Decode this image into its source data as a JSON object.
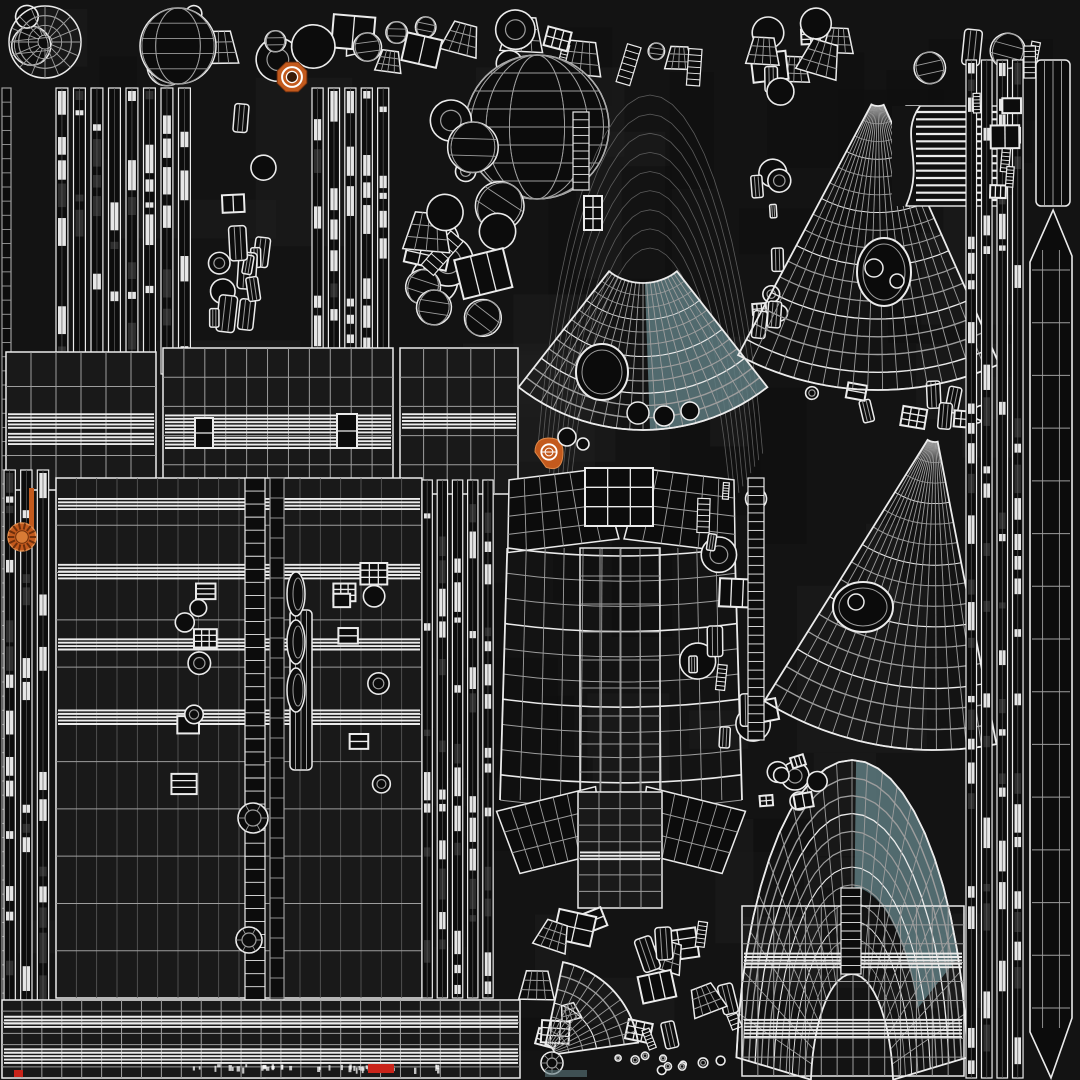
{
  "subject": "3D model UV wireframe texture atlas",
  "canvas": {
    "width": 1080,
    "height": 1080
  },
  "colors": {
    "background": "#131313",
    "line": "#ebebeb",
    "lineDim": "#9d9d9d",
    "lineFaint": "#5c5c5c",
    "fillDark": "#0c0c0c",
    "fillPanel": "#191919",
    "teal": "#5d7a7f",
    "tealLine": "#d9e4e4",
    "orange": "#c35a1d",
    "orangeLight": "#e08a4a",
    "red": "#c9241a",
    "white": "#ffffff"
  },
  "islands": [
    {
      "name": "background-patches",
      "type": "patchfield",
      "x": 0,
      "y": 0,
      "w": 1080,
      "h": 1080,
      "seed": 2,
      "count": 70
    },
    {
      "name": "top-parts-row",
      "type": "scatter",
      "x": 6,
      "y": 4,
      "w": 1054,
      "h": 82,
      "seed": 7,
      "count": 44,
      "kinds": [
        "winrect",
        "ring",
        "cyl",
        "sphere",
        "cone",
        "ladder"
      ],
      "smin": 16,
      "smax": 44,
      "rotmax": 18
    },
    {
      "name": "turbine-part",
      "type": "radialfan",
      "cx": 45,
      "cy": 42,
      "r0": 7,
      "r1": 36,
      "a0": 0,
      "a1": 360,
      "nr": 3,
      "ns": 16,
      "outline": true
    },
    {
      "name": "sphere-part-small",
      "type": "sphere",
      "cx": 178,
      "cy": 46,
      "r": 38,
      "nlat": 5,
      "nlon": 5
    },
    {
      "name": "orange-badge-top",
      "type": "badge",
      "style": "octagon",
      "cx": 292,
      "cy": 77,
      "r": 16
    },
    {
      "name": "sphere-part-large",
      "type": "sphere",
      "cx": 537,
      "cy": 127,
      "r": 72,
      "nlat": 8,
      "nlon": 8
    },
    {
      "name": "left-edge-ladder",
      "type": "ladder",
      "x": 2,
      "y": 88,
      "w": 9,
      "h": 990,
      "n": 70,
      "dim": true
    },
    {
      "name": "left-strip-bundle",
      "type": "vstrips",
      "x": 56,
      "y": 88,
      "w": 140,
      "h": 286,
      "count": 8,
      "seed": 3
    },
    {
      "name": "left-part-column",
      "type": "scatter",
      "x": 198,
      "y": 92,
      "w": 110,
      "h": 276,
      "seed": 11,
      "count": 14,
      "kinds": [
        "winrect",
        "cyl",
        "ring"
      ],
      "smin": 18,
      "smax": 40,
      "rotmax": 10
    },
    {
      "name": "mid-strip-bundle",
      "type": "vstrips",
      "x": 312,
      "y": 88,
      "w": 82,
      "h": 284,
      "count": 5,
      "seed": 5
    },
    {
      "name": "upper-mid-cluster",
      "type": "scatter",
      "x": 398,
      "y": 90,
      "w": 138,
      "h": 250,
      "seed": 9,
      "count": 16,
      "kinds": [
        "winrect",
        "ring",
        "cyl",
        "sphere",
        "cone",
        "ladder"
      ],
      "smin": 18,
      "smax": 52,
      "rotmax": 45
    },
    {
      "name": "upper-arc-band",
      "type": "radialfan",
      "cx": 650,
      "cy": 640,
      "r0": 392,
      "r1": 545,
      "a0": 200,
      "a1": 340,
      "nr": 8,
      "ns": 0,
      "aspect": 0.22,
      "dim": true
    },
    {
      "name": "arc-band-ladder",
      "type": "ladder",
      "x": 573,
      "y": 112,
      "w": 16,
      "h": 78,
      "n": 10
    },
    {
      "name": "arc-band-hatch",
      "type": "winrect",
      "x": 584,
      "y": 196,
      "w": 18,
      "h": 34,
      "cols": 2,
      "rows": 3
    },
    {
      "name": "eye-mesh",
      "type": "radialfan",
      "cx": 643,
      "cy": 228,
      "r0": 55,
      "r1": 202,
      "a0": 52,
      "a1": 128,
      "nr": 12,
      "ns": 20,
      "outline": true,
      "teal": {
        "a0": 52,
        "a1": 88,
        "r0": 55,
        "r1": 202
      },
      "hole": {
        "cx": 602,
        "cy": 372,
        "rx": 26,
        "ry": 28
      },
      "subholes": [
        [
          638,
          413,
          11
        ],
        [
          664,
          416,
          10
        ],
        [
          690,
          411,
          9
        ]
      ]
    },
    {
      "name": "hull-panel-a",
      "type": "hgrid",
      "x": 6,
      "y": 352,
      "w": 150,
      "h": 138,
      "nx": 6,
      "ny": 4,
      "bands": [
        {
          "fy": 0.5,
          "n": 5
        },
        {
          "fy": 0.63,
          "n": 4
        }
      ]
    },
    {
      "name": "hull-panel-b",
      "type": "hgrid",
      "x": 163,
      "y": 348,
      "w": 230,
      "h": 146,
      "nx": 11,
      "ny": 5,
      "bands": [
        {
          "fy": 0.52,
          "n": 6
        },
        {
          "fy": 0.65,
          "n": 4
        }
      ]
    },
    {
      "name": "hull-panel-c",
      "type": "hgrid",
      "x": 400,
      "y": 348,
      "w": 118,
      "h": 146,
      "nx": 5,
      "ny": 5,
      "bands": [
        {
          "fy": 0.5,
          "n": 5
        }
      ]
    },
    {
      "name": "hatch-detail-a",
      "type": "winrect",
      "x": 195,
      "y": 418,
      "w": 18,
      "h": 30,
      "cols": 1,
      "rows": 2
    },
    {
      "name": "hatch-detail-b",
      "type": "winrect",
      "x": 337,
      "y": 414,
      "w": 20,
      "h": 34,
      "cols": 1,
      "rows": 2
    },
    {
      "name": "left-column-strips",
      "type": "vstrips",
      "x": 4,
      "y": 470,
      "w": 50,
      "h": 606,
      "count": 3,
      "seed": 13
    },
    {
      "name": "orange-strip",
      "type": "orect",
      "x": 29,
      "y": 488,
      "w": 5,
      "h": 50
    },
    {
      "name": "orange-badge-left",
      "type": "badge",
      "style": "ribbed",
      "cx": 22,
      "cy": 537,
      "r": 14
    },
    {
      "name": "mid-hull-grid",
      "type": "hgrid",
      "x": 56,
      "y": 478,
      "w": 366,
      "h": 520,
      "nx": 18,
      "ny": 11,
      "dimv": true,
      "bands": [
        {
          "fy": 0.05,
          "n": 4
        },
        {
          "fy": 0.18,
          "n": 5
        },
        {
          "fy": 0.32,
          "n": 4
        },
        {
          "fy": 0.46,
          "n": 5
        }
      ]
    },
    {
      "name": "hatch-row-left",
      "type": "scatter",
      "x": 168,
      "y": 562,
      "w": 58,
      "h": 244,
      "seed": 17,
      "count": 8,
      "kinds": [
        "winrect",
        "ring"
      ],
      "smin": 14,
      "smax": 28,
      "rotmax": 0
    },
    {
      "name": "hatch-row-right",
      "type": "scatter",
      "x": 330,
      "y": 560,
      "w": 62,
      "h": 246,
      "seed": 19,
      "count": 8,
      "kinds": [
        "winrect",
        "ring"
      ],
      "smin": 14,
      "smax": 28,
      "rotmax": 0
    },
    {
      "name": "spine-ladder-a",
      "type": "ladder",
      "x": 245,
      "y": 478,
      "w": 20,
      "h": 600,
      "n": 46
    },
    {
      "name": "spine-ladder-b",
      "type": "ladder",
      "x": 270,
      "y": 478,
      "w": 14,
      "h": 600,
      "n": 30,
      "dim": true
    },
    {
      "name": "spine-cyl",
      "type": "cyl",
      "x": 290,
      "y": 610,
      "w": 22,
      "h": 160,
      "n": 4
    },
    {
      "name": "spine-crescents",
      "type": "crescents",
      "cx": 296,
      "ys": [
        594,
        642,
        690
      ],
      "rx": 9,
      "ry": 22
    },
    {
      "name": "grommet-a",
      "type": "ring",
      "cx": 253,
      "cy": 818,
      "r": 15,
      "r2": 8,
      "spokes": 6
    },
    {
      "name": "grommet-b",
      "type": "ring",
      "cx": 249,
      "cy": 940,
      "r": 13,
      "r2": 7,
      "spokes": 6
    },
    {
      "name": "grommet-c",
      "type": "ring",
      "cx": 247,
      "cy": 1042,
      "r": 11,
      "r2": 6,
      "spokes": 6
    },
    {
      "name": "right-of-hull-strips",
      "type": "vstrips",
      "x": 422,
      "y": 480,
      "w": 76,
      "h": 518,
      "count": 5,
      "seed": 39
    },
    {
      "name": "bottom-left-dense-grid",
      "type": "hgrid",
      "x": 2,
      "y": 1000,
      "w": 518,
      "h": 78,
      "nx": 26,
      "ny": 7,
      "bands": [
        {
          "fy": 0.28,
          "n": 4
        },
        {
          "fy": 0.72,
          "n": 5
        }
      ]
    },
    {
      "name": "vessel-shoulder-left",
      "type": "cone",
      "x": 503,
      "y": 474,
      "w": 112,
      "h": 72,
      "tw": 0.82,
      "bw": 1,
      "rot": -7,
      "nx": 6,
      "ny": 4
    },
    {
      "name": "vessel-shoulder-right",
      "type": "cone",
      "x": 628,
      "y": 474,
      "w": 112,
      "h": 72,
      "tw": 0.82,
      "bw": 1,
      "rot": 7,
      "nx": 6,
      "ny": 4
    },
    {
      "name": "vessel-collar",
      "type": "winrect",
      "x": 585,
      "y": 468,
      "w": 68,
      "h": 58,
      "cols": 3,
      "rows": 3
    },
    {
      "name": "vessel-body",
      "type": "bulgegrid",
      "x": 500,
      "y": 548,
      "w": 242,
      "h": 252,
      "nx": 12,
      "ny": 10,
      "bulge": 16,
      "taper": 0.94
    },
    {
      "name": "vessel-center-band",
      "type": "hgrid",
      "x": 580,
      "y": 548,
      "w": 80,
      "h": 252,
      "nx": 4,
      "ny": 9,
      "nofill": true
    },
    {
      "name": "vessel-skirt-left",
      "type": "cone",
      "x": 503,
      "y": 798,
      "w": 102,
      "h": 66,
      "tw": 1,
      "bw": 0.85,
      "rot": -14,
      "nx": 7,
      "ny": 3
    },
    {
      "name": "vessel-skirt-right",
      "type": "cone",
      "x": 637,
      "y": 798,
      "w": 102,
      "h": 66,
      "tw": 1,
      "bw": 0.85,
      "rot": 14,
      "nx": 7,
      "ny": 3
    },
    {
      "name": "vessel-neck",
      "type": "hgrid",
      "x": 578,
      "y": 792,
      "w": 84,
      "h": 116,
      "nx": 4,
      "ny": 7,
      "bands": [
        {
          "fy": 0.55,
          "n": 3
        }
      ]
    },
    {
      "name": "orange-badge-center",
      "type": "badge",
      "style": "teardrop",
      "cx": 549,
      "cy": 452,
      "r": 14
    },
    {
      "name": "vessel-rivet-a",
      "type": "ring",
      "cx": 567,
      "cy": 437,
      "r": 9
    },
    {
      "name": "vessel-rivet-b",
      "type": "ring",
      "cx": 583,
      "cy": 444,
      "r": 6
    },
    {
      "name": "lower-center-cluster",
      "type": "scatter",
      "x": 518,
      "y": 902,
      "w": 238,
      "h": 148,
      "seed": 23,
      "count": 20,
      "kinds": [
        "cyl",
        "ladder",
        "ring",
        "winrect",
        "cone"
      ],
      "smin": 14,
      "smax": 42,
      "rotmax": 22
    },
    {
      "name": "lower-fan-wedge",
      "type": "radialfan",
      "cx": 543,
      "cy": 1056,
      "r0": 12,
      "r1": 96,
      "a0": -78,
      "a1": -8,
      "nr": 6,
      "ns": 10,
      "outline": true
    },
    {
      "name": "gauge-ring",
      "type": "ring",
      "cx": 552,
      "cy": 1063,
      "r": 11,
      "r2": 5,
      "spokes": 8
    },
    {
      "name": "bottom-rivet-row",
      "type": "scatter",
      "x": 612,
      "y": 1052,
      "w": 150,
      "h": 24,
      "seed": 27,
      "count": 10,
      "kinds": [
        "ring"
      ],
      "smin": 6,
      "smax": 10,
      "rotmax": 0
    },
    {
      "name": "right-of-vessel-cluster",
      "type": "scatter",
      "x": 678,
      "y": 436,
      "w": 100,
      "h": 316,
      "seed": 37,
      "count": 14,
      "kinds": [
        "winrect",
        "cyl",
        "ring",
        "ladder"
      ],
      "smin": 14,
      "smax": 36,
      "rotmax": 12
    },
    {
      "name": "right-of-vessel-ladder",
      "type": "ladder",
      "x": 748,
      "y": 478,
      "w": 16,
      "h": 262,
      "n": 30
    },
    {
      "name": "eye-fan-gap-cluster",
      "type": "scatter",
      "x": 742,
      "y": 62,
      "w": 52,
      "h": 300,
      "seed": 33,
      "count": 12,
      "kinds": [
        "winrect",
        "cyl",
        "ring"
      ],
      "smin": 12,
      "smax": 30,
      "rotmax": 8
    },
    {
      "name": "fan-gap-cluster",
      "type": "scatter",
      "x": 768,
      "y": 380,
      "w": 230,
      "h": 50,
      "seed": 31,
      "count": 10,
      "kinds": [
        "winrect",
        "ring",
        "cyl"
      ],
      "smin": 12,
      "smax": 30,
      "rotmax": 15
    },
    {
      "name": "mountain-fan-upper",
      "type": "radialfan",
      "cx": 878,
      "cy": 92,
      "r0": 14,
      "r1": 298,
      "a0": 66,
      "a1": 118,
      "nr": 16,
      "ns": 18,
      "outline": true,
      "hole": {
        "cx": 884,
        "cy": 272,
        "rx": 27,
        "ry": 34
      },
      "subholes": [
        [
          874,
          268,
          9
        ],
        [
          897,
          281,
          7
        ]
      ]
    },
    {
      "name": "wavy-stripe-panel",
      "type": "stripepanel",
      "x": 906,
      "y": 106,
      "w": 100,
      "h": 100,
      "n": 13
    },
    {
      "name": "mountain-fan-lower",
      "type": "radialfan",
      "cx": 935,
      "cy": 428,
      "r0": 14,
      "r1": 322,
      "a0": 79,
      "a1": 122,
      "nr": 15,
      "ns": 16,
      "outline": true,
      "hole": {
        "cx": 863,
        "cy": 607,
        "rx": 30,
        "ry": 25
      },
      "subholes": [
        [
          856,
          602,
          8
        ]
      ]
    },
    {
      "name": "dome-mesh",
      "type": "radialfan",
      "cx": 852,
      "cy": 1092,
      "r0": 118,
      "r1": 332,
      "a0": 186,
      "a1": 354,
      "nr": 12,
      "ns": 22,
      "aspect": 0.35,
      "outline": true,
      "teal": {
        "a0": 272,
        "a1": 336,
        "r0": 205,
        "r1": 332
      }
    },
    {
      "name": "dome-lower-grid",
      "type": "hgrid",
      "x": 742,
      "y": 906,
      "w": 222,
      "h": 170,
      "nx": 14,
      "ny": 9,
      "nofill": true,
      "bands": [
        {
          "fy": 0.32,
          "n": 5
        },
        {
          "fy": 0.72,
          "n": 6
        }
      ]
    },
    {
      "name": "dome-hatch-ladder",
      "type": "ladder",
      "x": 841,
      "y": 888,
      "w": 20,
      "h": 86,
      "n": 10
    },
    {
      "name": "dome-ring-a",
      "type": "ring",
      "cx": 795,
      "cy": 776,
      "r": 14,
      "r2": 7
    },
    {
      "name": "dome-ring-b",
      "type": "ring",
      "cx": 799,
      "cy": 801,
      "r": 9
    },
    {
      "name": "dome-top-cluster",
      "type": "scatter",
      "x": 756,
      "y": 752,
      "w": 80,
      "h": 58,
      "seed": 43,
      "count": 6,
      "kinds": [
        "ring",
        "winrect"
      ],
      "smin": 10,
      "smax": 22,
      "rotmax": 20
    },
    {
      "name": "right-column-strips",
      "type": "vstrips",
      "x": 966,
      "y": 60,
      "w": 62,
      "h": 1018,
      "count": 4,
      "seed": 29
    },
    {
      "name": "right-capsule",
      "type": "cyl",
      "x": 1036,
      "y": 60,
      "w": 34,
      "h": 146,
      "n": 4
    },
    {
      "name": "right-blade",
      "type": "blade",
      "x": 1030,
      "y": 210,
      "w": 42,
      "h": 868,
      "n": 15
    },
    {
      "name": "top-right-cluster",
      "type": "scatter",
      "x": 966,
      "y": 92,
      "w": 60,
      "h": 110,
      "seed": 45,
      "count": 6,
      "kinds": [
        "winrect",
        "ladder"
      ],
      "smin": 14,
      "smax": 30,
      "rotmax": 6
    },
    {
      "name": "bottom-tick-marks",
      "type": "ticks",
      "x": 192,
      "y": 1066,
      "w": 250,
      "n": 42,
      "seed": 47
    },
    {
      "name": "red-mark-a",
      "type": "rrect",
      "x": 368,
      "y": 1064,
      "w": 26,
      "h": 9
    },
    {
      "name": "red-mark-b",
      "type": "rrect",
      "x": 14,
      "y": 1070,
      "w": 9,
      "h": 7
    },
    {
      "name": "teal-accent-bottom",
      "type": "trect",
      "x": 545,
      "y": 1070,
      "w": 42,
      "h": 7
    }
  ]
}
